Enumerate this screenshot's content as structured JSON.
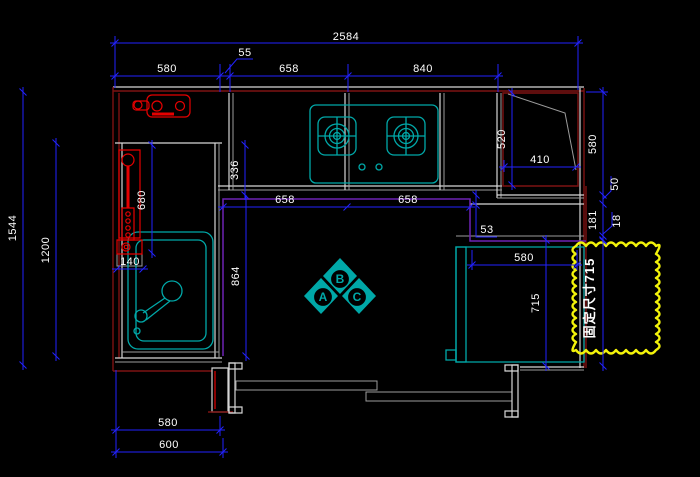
{
  "drawing": {
    "dims": {
      "top_total": "2584",
      "top_a": "580",
      "top_b": "55",
      "top_c": "658",
      "top_d": "840",
      "left_outer": "1544",
      "left_inner": "1200",
      "pipe_height": "680",
      "upper_depth": "336",
      "lower_depth": "864",
      "filler_width": "140",
      "base_a": "658",
      "base_b": "658",
      "step": "53",
      "corner_depth": "520",
      "corner_width": "410",
      "right_a": "580",
      "right_b": "50",
      "right_c": "181",
      "right_d": "18",
      "fridge_width": "580",
      "fridge_depth": "715",
      "bottom_a": "580",
      "bottom_b": "600"
    },
    "markers": {
      "a": "A",
      "b": "B",
      "c": "C"
    },
    "annotations": {
      "cloud_note": "固定尺寸715"
    },
    "colors": {
      "dim": "#2222ff",
      "line": "#d6d6d6",
      "line2": "#9c9c9c",
      "red": "#e60000",
      "darkred": "#7d1212",
      "teal": "#00a8a8",
      "purple": "#6d22b4",
      "yellow": "#f2f20a",
      "text": "#ffffff"
    }
  }
}
